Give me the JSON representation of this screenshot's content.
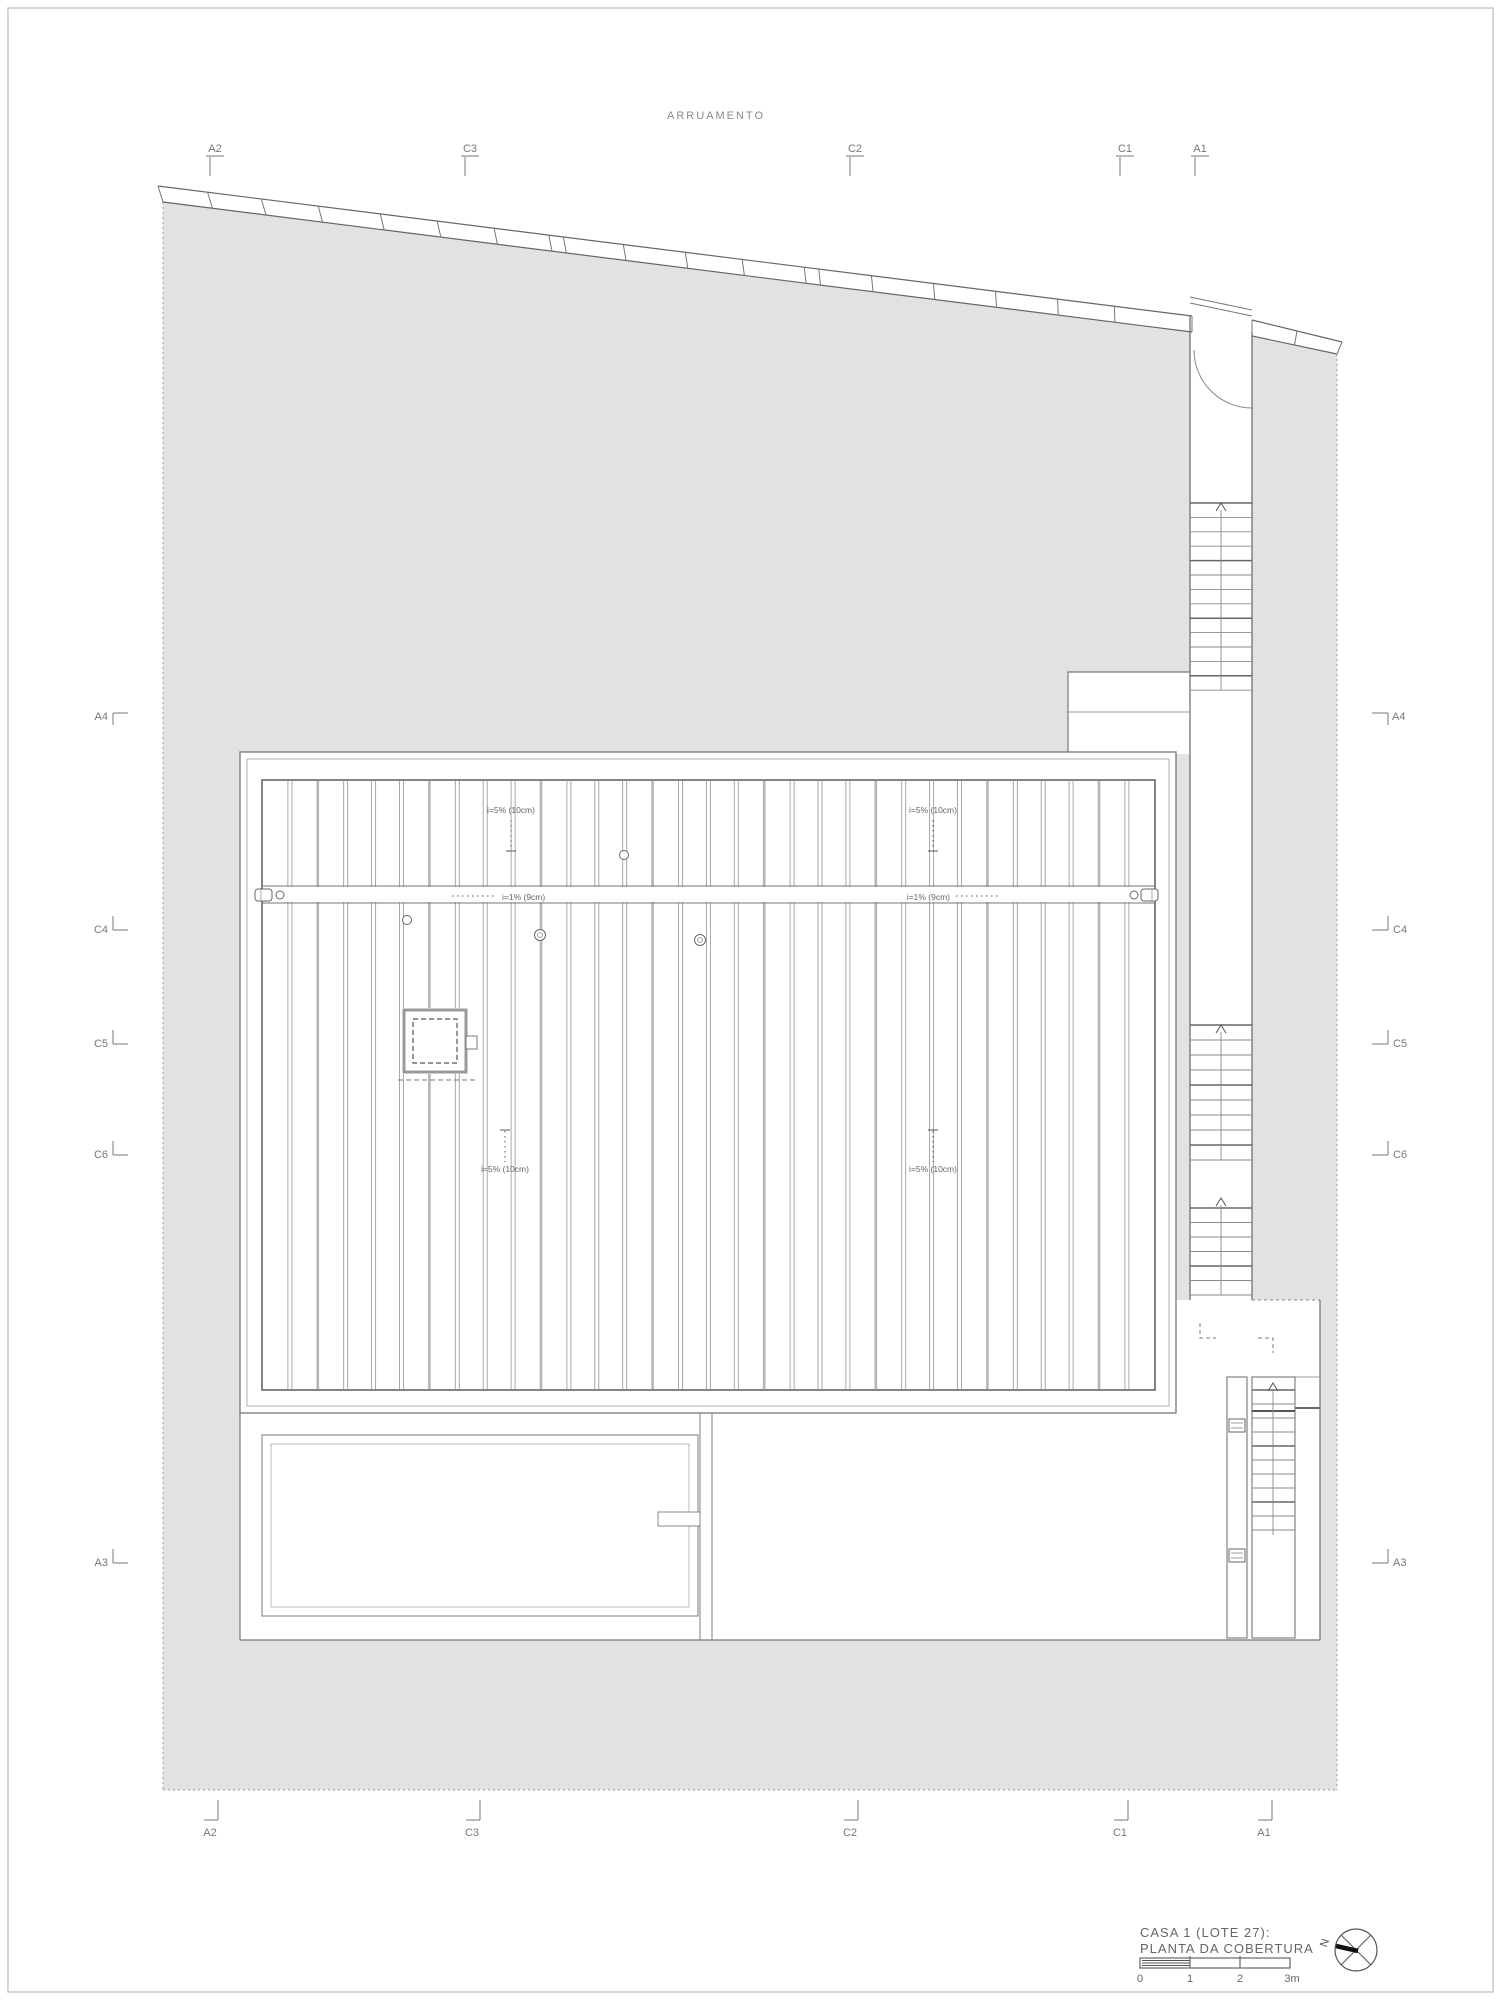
{
  "street_label": "ARRUAMENTO",
  "grid_markers": {
    "top": [
      "A2",
      "C3",
      "C2",
      "C1",
      "A1"
    ],
    "bottom": [
      "A2",
      "C3",
      "C2",
      "C1",
      "A1"
    ],
    "left": [
      "A4",
      "C4",
      "C5",
      "C6",
      "A3"
    ],
    "right": [
      "A4",
      "C4",
      "C5",
      "C6",
      "A3"
    ]
  },
  "roof": {
    "slope_label_top_left": "i=5% (10cm)",
    "slope_label_top_right": "i=5% (10cm)",
    "slope_label_bottom_left": "i=5% (10cm)",
    "slope_label_bottom_right": "i=5% (10cm)",
    "gutter_label_left": "i=1% (9cm)",
    "gutter_label_right": "i=1% (9cm)"
  },
  "title_block": {
    "line1": "CASA 1 (LOTE 27):",
    "line2": "PLANTA DA COBERTURA",
    "scale_ticks": [
      "0",
      "1",
      "2",
      "3m"
    ],
    "north_label": "N"
  },
  "colors": {
    "lot_fill": "#e2e2e2",
    "line_dark": "#555555",
    "line_mid": "#777777",
    "line_light": "#9e9e9e",
    "text_gray": "#777777"
  }
}
